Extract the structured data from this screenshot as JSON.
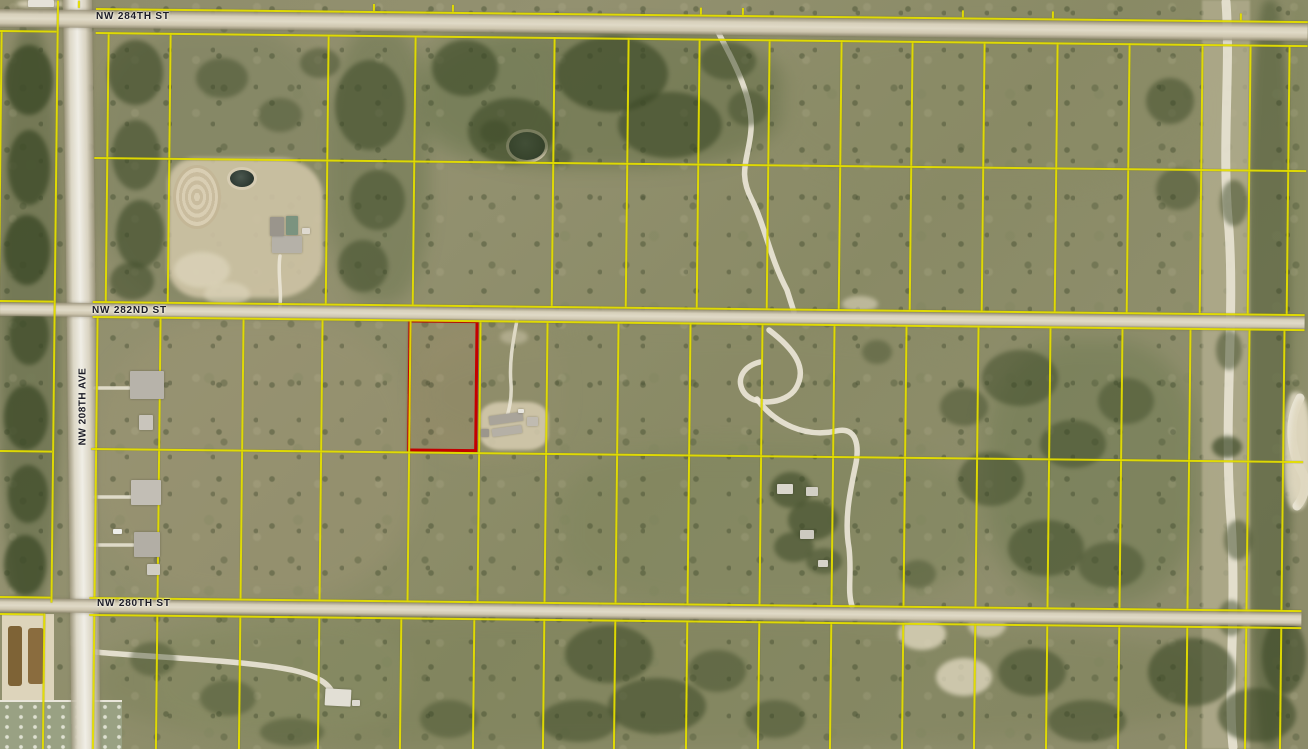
{
  "map": {
    "type": "aerial-parcel-map",
    "colors": {
      "parcel_line": "#e4de00",
      "highlight_parcel": "#c40000",
      "road": "#d8d1bc",
      "label_text": "#1b1b26",
      "trail": "#ece7d8"
    },
    "labels": {
      "top": {
        "text": "NW 284TH ST",
        "x": 96,
        "y": 11
      },
      "middle": {
        "text": "NW 282ND ST",
        "x": 92,
        "y": 305
      },
      "bottom": {
        "text": "NW 280TH ST",
        "x": 97,
        "y": 598
      },
      "avenue": {
        "text": "NW 208TH AVE",
        "x": 33,
        "y": 401
      }
    },
    "highlight": {
      "x": 412,
      "y": 315,
      "w": 70,
      "h": 132
    },
    "roads": {
      "horizontal": [
        {
          "y": 9,
          "h": 18
        },
        {
          "y": 302,
          "h": 14
        },
        {
          "y": 598,
          "h": 14
        }
      ]
    },
    "grid": {
      "bands": [
        {
          "name": "above-284th",
          "y1": 0,
          "y2": 7,
          "verticals": [
            78,
            373,
            452,
            700,
            742,
            962,
            1052,
            1240
          ],
          "bottom": 7
        },
        {
          "name": "284th-282nd",
          "y1": 31,
          "y2": 301,
          "verticals": [
            108,
            170,
            328,
            415,
            554,
            628,
            699,
            769,
            841,
            912,
            984,
            1057,
            1129,
            1202,
            1250,
            1289
          ],
          "top": 31,
          "mid": 156,
          "bottom": 300
        },
        {
          "name": "282nd-280th",
          "y1": 316,
          "y2": 597,
          "verticals": [
            100,
            163,
            246,
            325,
            413,
            483,
            550,
            621,
            693,
            765,
            837,
            909,
            981,
            1053,
            1125,
            1193,
            1252,
            1287
          ],
          "top": 315,
          "mid": 447,
          "bottom": 596
        },
        {
          "name": "below-280th",
          "y1": 613,
          "y2": 749,
          "verticals": [
            100,
            163,
            246,
            325,
            407,
            480,
            550,
            621,
            693,
            765,
            837,
            909,
            981,
            1053,
            1125,
            1193,
            1252,
            1287
          ],
          "top": 613
        }
      ],
      "extra_verticals": [
        [
          1,
          30,
          719
        ],
        [
          57,
          0,
          602
        ],
        [
          50,
          613,
          136
        ]
      ],
      "extra_horizontals": [
        [
          0,
          30,
          57
        ],
        [
          0,
          300,
          57
        ],
        [
          0,
          450,
          57
        ],
        [
          0,
          596,
          57
        ],
        [
          2,
          613,
          48
        ]
      ]
    },
    "trails": {
      "t1": "M718,32 C736,66 753,98 751,130 C749,158 737,172 752,200 C765,226 770,258 787,290 L794,312",
      "t2": "M769,330 C794,349 808,368 796,388 C786,405 752,407 743,391 C736,378 744,366 760,362",
      "t3": "M757,399 C775,424 806,438 836,431 C857,426 860,446 855,468 C850,492 844,520 849,548 C852,574 847,590 852,606",
      "t4": "M280,256 C277,274 283,294 279,312",
      "t5": "M95,652 C160,658 242,660 292,670 C318,676 331,684 334,697",
      "t6": "M517,320 C513,342 509,362 511,384 C512,400 509,410 507,416",
      "t7": "M1226,2 C1231,70 1221,150 1229,230 C1235,320 1223,420 1231,520 C1237,610 1227,690 1233,747",
      "t8": "M1300,398 C1287,422 1291,452 1302,472 C1308,482 1305,496 1297,506",
      "d1": "M95,388 L129,388",
      "d2": "M95,497 L131,497",
      "d3": "M95,545 L133,545"
    },
    "decor": {
      "patches": [
        [
          0,
          28,
          60,
          580,
          "#5e6844",
          0.55,
          5
        ],
        [
          96,
          28,
          240,
          280,
          "#7d8260",
          0.5,
          8
        ],
        [
          330,
          28,
          100,
          275,
          "#6f7852",
          0.55,
          8
        ],
        [
          425,
          28,
          360,
          140,
          "#636e46",
          0.5,
          9
        ],
        [
          780,
          28,
          420,
          160,
          "#8a8b66",
          0.45,
          10
        ],
        [
          415,
          31,
          140,
          130,
          "#77805a",
          0.45,
          8
        ],
        [
          96,
          320,
          320,
          280,
          "#9a9372",
          0.5,
          10
        ],
        [
          415,
          325,
          150,
          135,
          "#97916f",
          0.5,
          8
        ],
        [
          420,
          330,
          560,
          130,
          "#8c8c68",
          0.4,
          10
        ],
        [
          560,
          440,
          420,
          170,
          "#7e855c",
          0.45,
          10
        ],
        [
          985,
          340,
          215,
          265,
          "#6d7950",
          0.5,
          10
        ],
        [
          96,
          615,
          1110,
          134,
          "#7b8058",
          0.45,
          10
        ],
        [
          1248,
          0,
          44,
          749,
          "#55603c",
          0.6,
          4
        ],
        [
          1289,
          0,
          19,
          400,
          "#7d8458",
          0.5,
          6
        ],
        [
          150,
          615,
          260,
          120,
          "#8a8e66",
          0.4,
          8
        ]
      ],
      "shrubs": [
        [
          5,
          45,
          48,
          70,
          0.8
        ],
        [
          8,
          130,
          42,
          75,
          0.75
        ],
        [
          4,
          215,
          46,
          70,
          0.8
        ],
        [
          9,
          305,
          40,
          60,
          0.7
        ],
        [
          4,
          385,
          44,
          65,
          0.75
        ],
        [
          8,
          465,
          40,
          58,
          0.7
        ],
        [
          4,
          535,
          42,
          60,
          0.75
        ],
        [
          108,
          40,
          55,
          65,
          0.6
        ],
        [
          112,
          120,
          48,
          70,
          0.55
        ],
        [
          116,
          200,
          48,
          68,
          0.6
        ],
        [
          110,
          262,
          44,
          38,
          0.55
        ],
        [
          196,
          58,
          52,
          40,
          0.45
        ],
        [
          258,
          98,
          44,
          34,
          0.4
        ],
        [
          300,
          48,
          40,
          30,
          0.45
        ],
        [
          335,
          60,
          70,
          90,
          0.55
        ],
        [
          350,
          170,
          55,
          60,
          0.5
        ],
        [
          338,
          240,
          50,
          52,
          0.5
        ],
        [
          432,
          40,
          66,
          56,
          0.6
        ],
        [
          468,
          98,
          88,
          66,
          0.6
        ],
        [
          556,
          36,
          112,
          76,
          0.65
        ],
        [
          618,
          92,
          104,
          66,
          0.6
        ],
        [
          700,
          42,
          56,
          38,
          0.5
        ],
        [
          728,
          90,
          40,
          36,
          0.45
        ],
        [
          480,
          120,
          30,
          24,
          0.5
        ],
        [
          548,
          148,
          24,
          18,
          0.45
        ],
        [
          1146,
          78,
          48,
          46,
          0.5
        ],
        [
          1156,
          168,
          44,
          42,
          0.45
        ],
        [
          940,
          388,
          48,
          38,
          0.45
        ],
        [
          982,
          350,
          76,
          56,
          0.5
        ],
        [
          1040,
          420,
          66,
          48,
          0.5
        ],
        [
          1098,
          378,
          56,
          46,
          0.45
        ],
        [
          958,
          452,
          66,
          54,
          0.5
        ],
        [
          1008,
          520,
          76,
          56,
          0.5
        ],
        [
          1078,
          542,
          66,
          46,
          0.45
        ],
        [
          1212,
          436,
          30,
          22,
          0.7
        ],
        [
          1216,
          330,
          26,
          40,
          0.5
        ],
        [
          1220,
          180,
          28,
          46,
          0.5
        ],
        [
          1224,
          520,
          28,
          40,
          0.5
        ],
        [
          1218,
          600,
          26,
          36,
          0.5
        ],
        [
          770,
          472,
          42,
          36,
          0.6
        ],
        [
          788,
          500,
          50,
          40,
          0.6
        ],
        [
          774,
          532,
          40,
          30,
          0.55
        ],
        [
          806,
          548,
          36,
          26,
          0.5
        ],
        [
          565,
          625,
          88,
          58,
          0.55
        ],
        [
          608,
          678,
          98,
          56,
          0.55
        ],
        [
          540,
          700,
          78,
          42,
          0.5
        ],
        [
          688,
          650,
          58,
          42,
          0.45
        ],
        [
          745,
          700,
          60,
          38,
          0.45
        ],
        [
          998,
          648,
          68,
          48,
          0.5
        ],
        [
          1048,
          700,
          78,
          42,
          0.5
        ],
        [
          1148,
          638,
          88,
          68,
          0.6
        ],
        [
          1218,
          688,
          78,
          54,
          0.6
        ],
        [
          1262,
          618,
          44,
          76,
          0.6
        ],
        [
          200,
          680,
          56,
          36,
          0.4
        ],
        [
          260,
          718,
          64,
          28,
          0.4
        ],
        [
          420,
          700,
          58,
          38,
          0.4
        ],
        [
          130,
          642,
          46,
          34,
          0.4
        ],
        [
          862,
          340,
          30,
          24,
          0.4
        ],
        [
          900,
          560,
          36,
          28,
          0.4
        ]
      ],
      "sands": [
        [
          898,
          618,
          48,
          32,
          0.8
        ],
        [
          936,
          658,
          56,
          38,
          0.8
        ],
        [
          968,
          612,
          38,
          26,
          0.7
        ],
        [
          842,
          296,
          36,
          16,
          0.6
        ],
        [
          174,
          252,
          56,
          36,
          0.7
        ],
        [
          204,
          282,
          46,
          24,
          0.6
        ],
        [
          16,
          0,
          48,
          8,
          0.9
        ],
        [
          500,
          330,
          28,
          14,
          0.4
        ],
        [
          1290,
          398,
          22,
          110,
          0.85
        ]
      ]
    },
    "buildings": [
      [
        272,
        236,
        30,
        17,
        "#b5b1a8",
        0
      ],
      [
        286,
        216,
        12,
        19,
        "#7b937f",
        0
      ],
      [
        270,
        217,
        14,
        19,
        "#9a958c",
        0
      ],
      [
        302,
        228,
        8,
        6,
        "#ded9cf",
        0
      ],
      [
        130,
        371,
        34,
        28,
        "#b7b3aa",
        0
      ],
      [
        139,
        415,
        14,
        15,
        "#c9c5bc",
        0
      ],
      [
        131,
        480,
        30,
        25,
        "#c2beb5",
        0
      ],
      [
        134,
        532,
        26,
        25,
        "#b2aea5",
        0
      ],
      [
        147,
        564,
        13,
        11,
        "#cfccc3",
        0
      ],
      [
        113,
        529,
        9,
        5,
        "#eeeeea",
        0
      ],
      [
        489,
        414,
        34,
        9,
        "#a9a49a",
        -8
      ],
      [
        492,
        427,
        30,
        8,
        "#b5b0a6",
        -8
      ],
      [
        527,
        417,
        11,
        9,
        "#c0bbb1",
        0
      ],
      [
        481,
        429,
        8,
        8,
        "#9b968c",
        0
      ],
      [
        518,
        409,
        6,
        4,
        "#e8e6df",
        0
      ],
      [
        777,
        484,
        16,
        10,
        "#dad7cd",
        0
      ],
      [
        806,
        487,
        12,
        9,
        "#d2cfc5",
        0
      ],
      [
        800,
        530,
        14,
        9,
        "#cdcac0",
        0
      ],
      [
        818,
        560,
        10,
        7,
        "#d6d3c9",
        0
      ],
      [
        28,
        0,
        26,
        7,
        "#e5e2d8",
        0
      ],
      [
        325,
        689,
        26,
        17,
        "#e2dfd5",
        3
      ],
      [
        352,
        700,
        8,
        6,
        "#dcd9cf",
        0
      ]
    ]
  }
}
